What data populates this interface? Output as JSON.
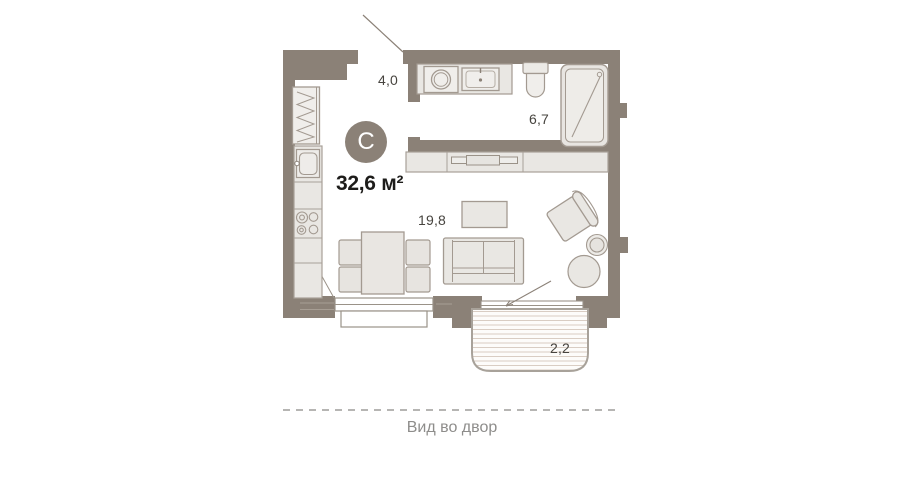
{
  "plan": {
    "type_badge": "С",
    "total_area": "32,6 м²",
    "rooms": [
      {
        "name": "hallway",
        "area": "4,0"
      },
      {
        "name": "bathroom",
        "area": "6,7"
      },
      {
        "name": "living-room",
        "area": "19,8"
      },
      {
        "name": "balcony",
        "area": "2,2"
      }
    ],
    "caption": "Вид во двор"
  },
  "colors": {
    "wall": "#8b8177",
    "wall_step_line": "#a79e94",
    "furniture_fill": "#e9e7e3",
    "furniture_stroke": "#a39a91",
    "balcony_hatch": "#d9cdc3",
    "label_text": "#47443f",
    "area_text": "#1d1c1a",
    "caption_text": "#8e8d8b",
    "dashed_line": "#b6b5b3",
    "badge_text": "#ffffff"
  }
}
